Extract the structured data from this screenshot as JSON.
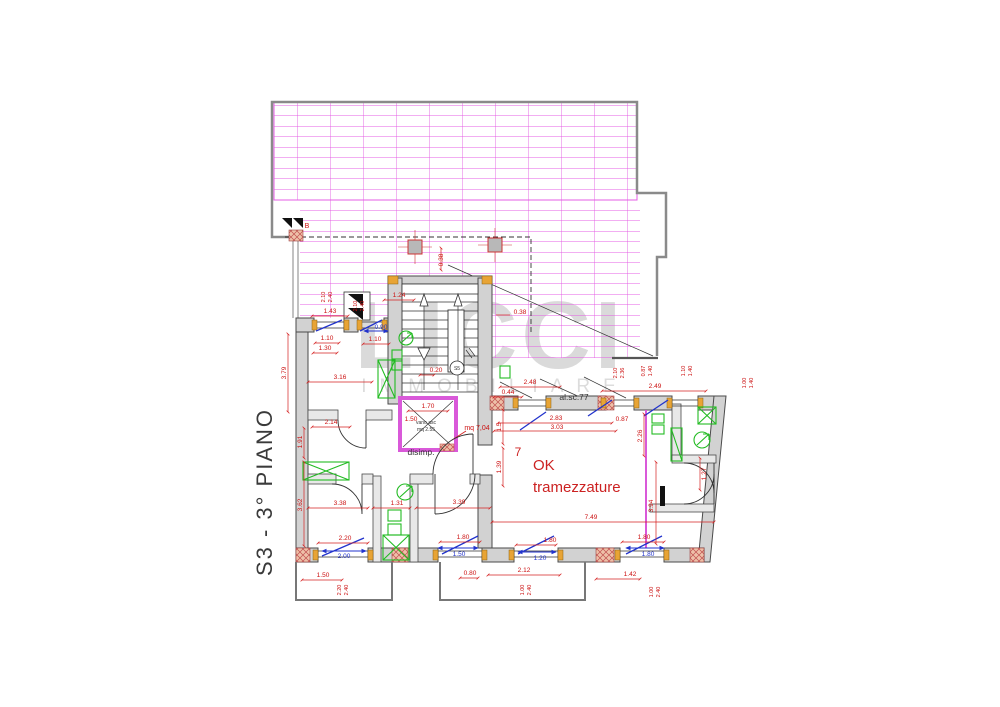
{
  "drawing": {
    "floor_title": "S3  -  3°  PIANO",
    "watermark": {
      "brand": "LICCI",
      "sub": "IMMOBILIARE"
    },
    "annotations": {
      "ok_line1": "OK",
      "ok_line2": "tramezzature",
      "room_number": "7",
      "hallway_label": "disimp.",
      "elevator_label_1": "vano asc",
      "elevator_label_2": "mq 2.55",
      "elevator_area": "mq 7,04",
      "stair_height_note": "al.sc.77",
      "stair_marker": "S5",
      "detail_marker": "B"
    },
    "colors": {
      "terrace_grid": "#e45ce4",
      "new_partition_pink": "#d959d9",
      "dimension_red": "#cc1111",
      "dimension_blue": "#2233cc",
      "fixture_green": "#22bb22",
      "wall_fill": "#d2d2d2",
      "outline_gray": "#8a8a8a",
      "jamb_orange": "#e8a435",
      "watermark_gray": "#dadada"
    },
    "dimensions": {
      "red": [
        {
          "t": "1.43",
          "x": 330,
          "y": 313
        },
        {
          "t": "1.24",
          "x": 399,
          "y": 297
        },
        {
          "t": "1.10",
          "x": 327,
          "y": 340
        },
        {
          "t": "1.30",
          "x": 325,
          "y": 350
        },
        {
          "t": "1.10",
          "x": 375,
          "y": 341
        },
        {
          "t": "0.38",
          "x": 520,
          "y": 314
        },
        {
          "t": "0.38",
          "x": 443,
          "y": 260,
          "r": -90
        },
        {
          "t": "0.20",
          "x": 436,
          "y": 372
        },
        {
          "t": "3.16",
          "x": 340,
          "y": 379
        },
        {
          "t": "3.79",
          "x": 286,
          "y": 373,
          "r": -90
        },
        {
          "t": "2.14",
          "x": 331,
          "y": 424
        },
        {
          "t": "1.91",
          "x": 302,
          "y": 442,
          "r": -90
        },
        {
          "t": "3.62",
          "x": 302,
          "y": 505,
          "r": -90
        },
        {
          "t": "3.38",
          "x": 340,
          "y": 505
        },
        {
          "t": "1.31",
          "x": 397,
          "y": 505
        },
        {
          "t": "3.39",
          "x": 459,
          "y": 504
        },
        {
          "t": "1.70",
          "x": 428,
          "y": 408
        },
        {
          "t": "1.50",
          "x": 411,
          "y": 421
        },
        {
          "t": "1.5",
          "x": 501,
          "y": 427,
          "r": -90
        },
        {
          "t": "1.39",
          "x": 501,
          "y": 467,
          "r": -90
        },
        {
          "t": "2.83",
          "x": 556,
          "y": 420
        },
        {
          "t": "3.03",
          "x": 557,
          "y": 429
        },
        {
          "t": "2.48",
          "x": 530,
          "y": 384
        },
        {
          "t": "0.44",
          "x": 508,
          "y": 394
        },
        {
          "t": "2.49",
          "x": 655,
          "y": 388
        },
        {
          "t": "0.87",
          "x": 622,
          "y": 421
        },
        {
          "t": "2.26",
          "x": 642,
          "y": 436,
          "r": -90
        },
        {
          "t": "1.27",
          "x": 706,
          "y": 474,
          "r": -90
        },
        {
          "t": "3.94",
          "x": 653,
          "y": 506,
          "r": -90
        },
        {
          "t": "7.49",
          "x": 591,
          "y": 519
        },
        {
          "t": "2.20",
          "x": 345,
          "y": 540
        },
        {
          "t": "1.50",
          "x": 323,
          "y": 577
        },
        {
          "t": "1.80",
          "x": 463,
          "y": 539
        },
        {
          "t": "0.80",
          "x": 470,
          "y": 575
        },
        {
          "t": "2.12",
          "x": 524,
          "y": 572
        },
        {
          "t": "1.80",
          "x": 550,
          "y": 542
        },
        {
          "t": "1.42",
          "x": 630,
          "y": 576
        },
        {
          "t": "1.80",
          "x": 644,
          "y": 539
        }
      ],
      "blue": [
        {
          "t": "0.90",
          "x": 381,
          "y": 329
        },
        {
          "t": "2.00",
          "x": 344,
          "y": 558
        },
        {
          "t": "1.50",
          "x": 459,
          "y": 556
        },
        {
          "t": "1.20",
          "x": 540,
          "y": 560
        },
        {
          "t": "1.80",
          "x": 648,
          "y": 556
        }
      ],
      "pairs": [
        {
          "a": "2.10",
          "b": "2.40",
          "x": 328,
          "y": 297
        },
        {
          "a": "2.10",
          "b": "2.40",
          "x": 360,
          "y": 306
        },
        {
          "a": "2.10",
          "b": "2.36",
          "x": 620,
          "y": 373
        },
        {
          "a": "0.87",
          "b": "1.40",
          "x": 648,
          "y": 371
        },
        {
          "a": "1.10",
          "b": "1.40",
          "x": 688,
          "y": 371
        },
        {
          "a": "1.00",
          "b": "1.40",
          "x": 749,
          "y": 383
        },
        {
          "a": "2.20",
          "b": "2.40",
          "x": 344,
          "y": 590
        },
        {
          "a": "1.00",
          "b": "2.40",
          "x": 527,
          "y": 590
        },
        {
          "a": "1.00",
          "b": "2.40",
          "x": 656,
          "y": 592
        }
      ]
    }
  }
}
